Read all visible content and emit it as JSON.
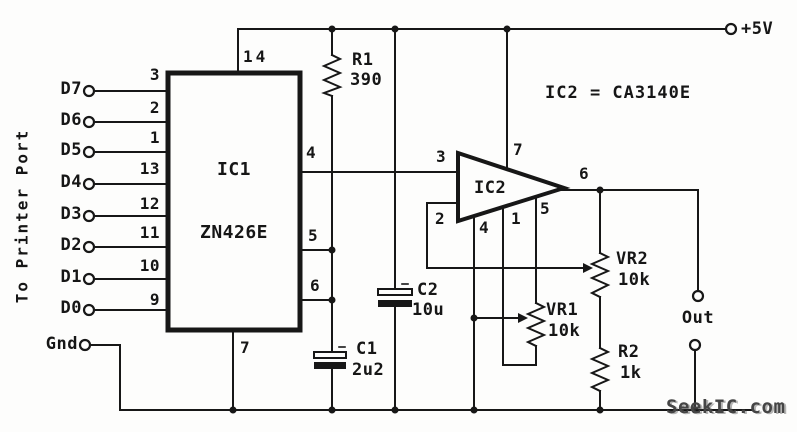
{
  "connector": {
    "rotated_label": "To Printer Port",
    "gnd_label": "Gnd",
    "lines": [
      {
        "label": "D7",
        "pin": "3"
      },
      {
        "label": "D6",
        "pin": "2"
      },
      {
        "label": "D5",
        "pin": "1"
      },
      {
        "label": "D4",
        "pin": "13"
      },
      {
        "label": "D3",
        "pin": "12"
      },
      {
        "label": "D2",
        "pin": "11"
      },
      {
        "label": "D1",
        "pin": "10"
      },
      {
        "label": "D0",
        "pin": "9"
      }
    ]
  },
  "power": {
    "supply_label": "+5V"
  },
  "ic1": {
    "designator": "IC1",
    "part": "ZN426E",
    "pin_top": "14",
    "pin_bottom": "7",
    "pin_out": "4",
    "pin_ref_in": "5",
    "pin_ref_out": "6"
  },
  "ic2": {
    "designator": "IC2",
    "note": "IC2 = CA3140E",
    "pin_noninv": "3",
    "pin_inv": "2",
    "pin_vplus": "7",
    "pin_vminus": "4",
    "pin_offset1": "1",
    "pin_offset2": "5",
    "pin_out": "6"
  },
  "components": {
    "r1": {
      "ref": "R1",
      "value": "390"
    },
    "c1": {
      "ref": "C1",
      "value": "2u2"
    },
    "c2": {
      "ref": "C2",
      "value": "10u"
    },
    "vr1": {
      "ref": "VR1",
      "value": "10k"
    },
    "vr2": {
      "ref": "VR2",
      "value": "10k"
    },
    "r2": {
      "ref": "R2",
      "value": "1k"
    }
  },
  "output": {
    "label": "Out"
  },
  "watermark": {
    "text": "SeekIC.com"
  },
  "colors": {
    "line": "#171717",
    "background": "#fdfdfc"
  }
}
